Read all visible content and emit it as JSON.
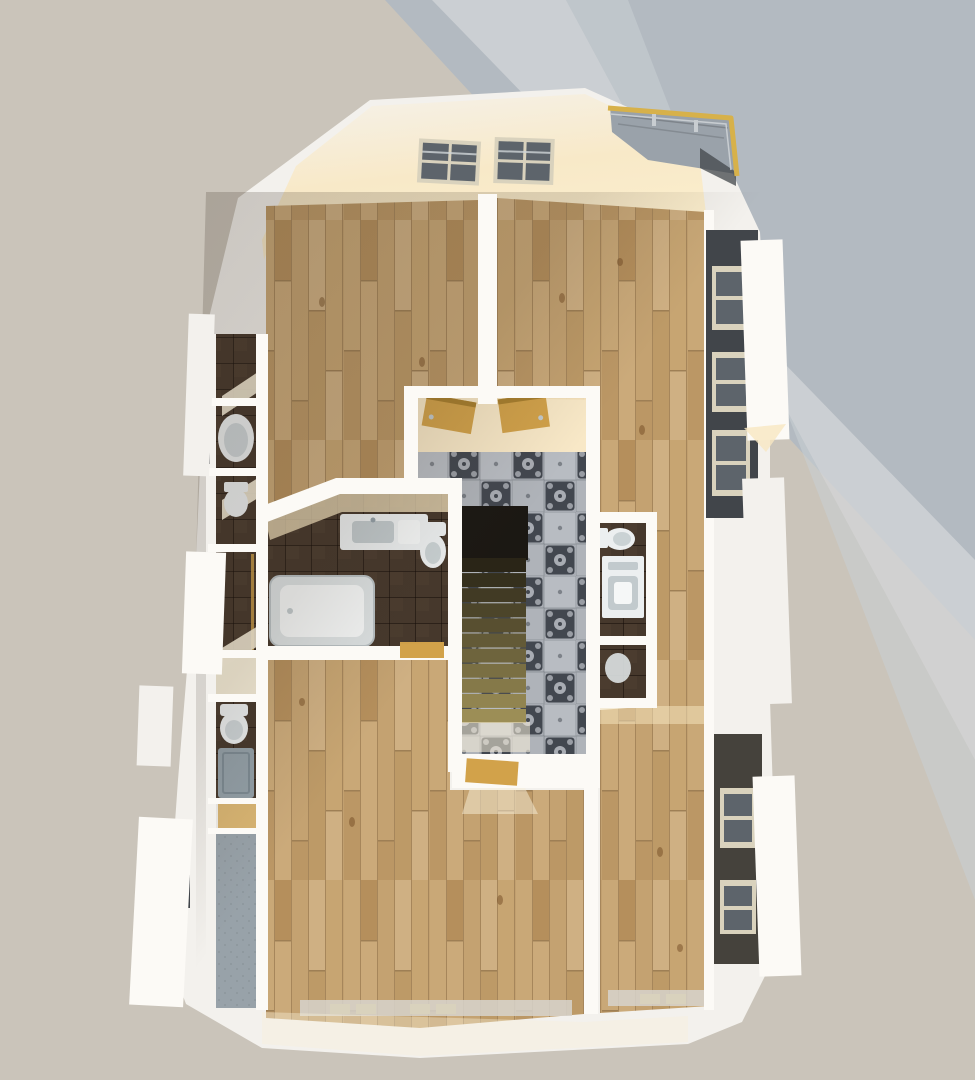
{
  "meta": {
    "description": "Top-down 3D architectural render of an apartment upper floor plan",
    "view": "aerial dollhouse cutaway"
  },
  "palette": {
    "bg_base": "#cac4ba",
    "bg_blue": "#b3bac1",
    "bg_streak1": "#d3d6d8",
    "bg_streak2": "#c9cfd3",
    "wall": "#f3f1ed",
    "wall_bright": "#fcfaf6",
    "wall_shade": "#e3e0da",
    "wall_dim": "#d7d4cd",
    "glow": "#f8e7c2",
    "glow_soft": "#f7efda",
    "wood_base": "#c2a06f",
    "wood_1": "#c9a877",
    "wood_2": "#bb9765",
    "wood_3": "#b58f5c",
    "wood_4": "#cbaa7a",
    "wood_5": "#c4a271",
    "wood_6": "#cfb083",
    "wood_7": "#bd9a67",
    "wood_8": "#c7a572",
    "wood_seam": "#8f714a",
    "knot": "rgba(115,76,35,0.5)",
    "tile_base": "#a8acb3",
    "tile_light": "#b8bcc2",
    "tile_mid": "#afb3b9",
    "tile_dark": "#42474f",
    "darkfloor": "#46382c",
    "darkfloor_grout": "rgba(18,10,6,0.5)",
    "darkfloor_var": "#4d3e31",
    "corridor": "#98a2a9",
    "corridor_dot": "rgba(30,35,40,0.10)",
    "fixture": "#eceff0",
    "fixture_dim": "#dde2e3",
    "fixture_inner": "#f5f7f7",
    "fixture_gray": "#c2cacd",
    "tray": "#93a0a8",
    "door_gold": "#d2a24a",
    "door_gold_dark": "#a87f2e",
    "stair_dark": "#2a2517",
    "stair_light": "#9c8e56",
    "stair_void": "#1b1813",
    "facade": "#41454a",
    "facade_low": "#45423c",
    "facade_window": "#d9d2bd",
    "facade_pane": "#5d646b",
    "rail_gold": "#d7b14a",
    "deck": "#9aa2aa",
    "cable": "#c8cdd1"
  },
  "scene": {
    "type": "3d-floor-plan-render",
    "rooms": [
      {
        "id": "room-top-left",
        "floor": "wood-parquet"
      },
      {
        "id": "room-right-l-shaped",
        "floor": "wood-parquet"
      },
      {
        "id": "room-bottom-left",
        "floor": "wood-parquet"
      },
      {
        "id": "hallway-stairwell",
        "floor": "patterned-cement-tile"
      },
      {
        "id": "bathroom-main",
        "floor": "dark-tile",
        "fixtures": [
          "bathtub",
          "vanity-sink",
          "toilet"
        ]
      },
      {
        "id": "wc-laundry",
        "floor": "dark-tile",
        "fixtures": [
          "toilet",
          "washing-machine",
          "basin"
        ]
      },
      {
        "id": "left-service-cells",
        "floor": "dark-tile",
        "fixtures": [
          "corner-tub",
          "toilet",
          "shower-tray",
          "toilet"
        ]
      },
      {
        "id": "wardrobe-corridor",
        "floor": "concrete-gray"
      }
    ],
    "stairs": {
      "treads": 11,
      "direction": "down",
      "material": "wood"
    },
    "skylights": {
      "count": 2,
      "panes_per_skylight": 4
    },
    "balcony": {
      "position": "top-right",
      "railing": "gold-metal",
      "deck": "gray-planks"
    },
    "doors": [
      {
        "id": "door-vestibule-left",
        "state": "open"
      },
      {
        "id": "door-vestibule-right",
        "state": "open"
      },
      {
        "id": "door-hall-bottom",
        "state": "open"
      },
      {
        "id": "door-bathroom-south",
        "state": "open"
      }
    ],
    "window_sills": {
      "bottom_left_room": 2,
      "bottom_right_room": 1
    },
    "facade_windows": {
      "right_upper": 3,
      "right_lower": 2,
      "left": 2
    }
  }
}
